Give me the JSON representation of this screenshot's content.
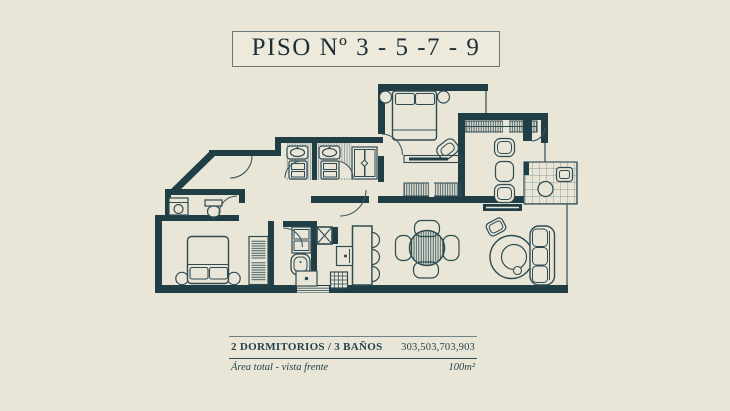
{
  "title": {
    "text": "PISO Nº 3 - 5 -7 - 9"
  },
  "footer": {
    "spec_bold": "2 DORMITORIOS / 3 BAÑOS",
    "units": "303,503,703,903",
    "area_label": "Área total - vista frente",
    "area_value": "100m²"
  },
  "colors": {
    "background": "#e9e6d8",
    "wall": "#1f3e46",
    "furniture_stroke": "#2e4b52",
    "title_border": "#68797c",
    "text": "#24434b"
  },
  "plan_icons": [
    "double-bed-icon",
    "nightstand-icon",
    "armchair-icon",
    "shelf-icon",
    "dresser-icon",
    "double-vanity-icon",
    "toilet-icon",
    "closet-icon",
    "entry-door-icon",
    "kitchen-counter-icon",
    "sink-icon",
    "stove-icon",
    "breakfast-chair-icon",
    "dining-table-icon",
    "dining-chair-icon",
    "bar-counter-icon",
    "bar-stool-icon",
    "sofa-icon",
    "lounge-chair-icon",
    "ottoman-icon",
    "bathtub-icon",
    "washer-icon",
    "shaft-icon",
    "wardrobe-icon",
    "door-swing-icon"
  ]
}
